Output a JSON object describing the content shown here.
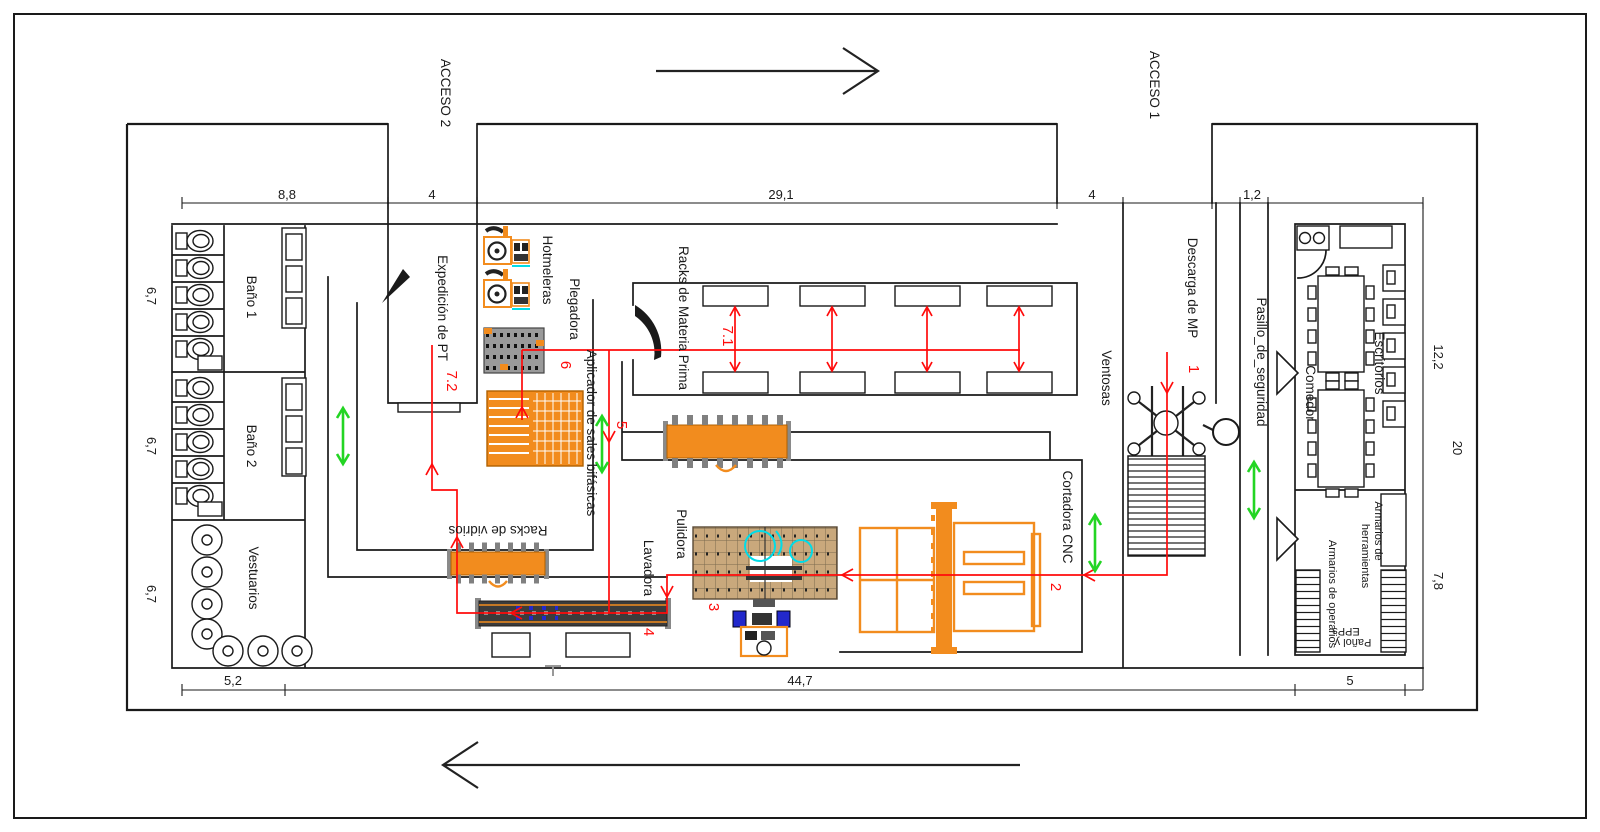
{
  "colors": {
    "wall": "#1a1a1a",
    "machine": "#F28C1E",
    "flow": "#FF0B0B",
    "walk": "#23D523",
    "detail": "#00DCE8"
  },
  "accesses": {
    "a2": "ACCESO 2",
    "a1": "ACCESO 1"
  },
  "rooms": {
    "bano1": "Baño 1",
    "bano2": "Baño 2",
    "vestuarios": "Vestuarios",
    "expedicion": "Expedición de PT",
    "racks_mp": "Racks de Materia Prima",
    "racks_vidrios": "Racks de vidrios",
    "ventosas": "Ventosas",
    "descarga": "Descarga de MP",
    "pasillo": "Pasillo_de_seguridad",
    "comedor": "Comedor",
    "escritorios": "Escritorios",
    "armarios_herr_l1": "Armarios de",
    "armarios_herr_l2": "herramientas",
    "armarios_oper": "Armarios de operarios",
    "panol_l1": "Pañol y",
    "panol_l2": "EPPs"
  },
  "machines": {
    "hotmeleras": "Hotmeleras",
    "plegadora": "Plegadora",
    "aplicador": "Aplicador de sales bifásicas",
    "lavadora": "Lavadora",
    "pulidora": "Pulidora",
    "cortadora": "Cortadora CNC"
  },
  "flow_steps": {
    "s1": "1",
    "s2": "2",
    "s3": "3",
    "s4": "4",
    "s5": "5",
    "s6": "6",
    "s71": "7.1",
    "s72": "7.2"
  },
  "dims": {
    "top": [
      "8,8",
      "4",
      "29,1",
      "4",
      "1,2"
    ],
    "left": [
      "6,7",
      "6,7",
      "6,7"
    ],
    "right": [
      "12,2",
      "20",
      "7,8"
    ],
    "bottom": [
      "5,2",
      "44,7",
      "5"
    ]
  }
}
